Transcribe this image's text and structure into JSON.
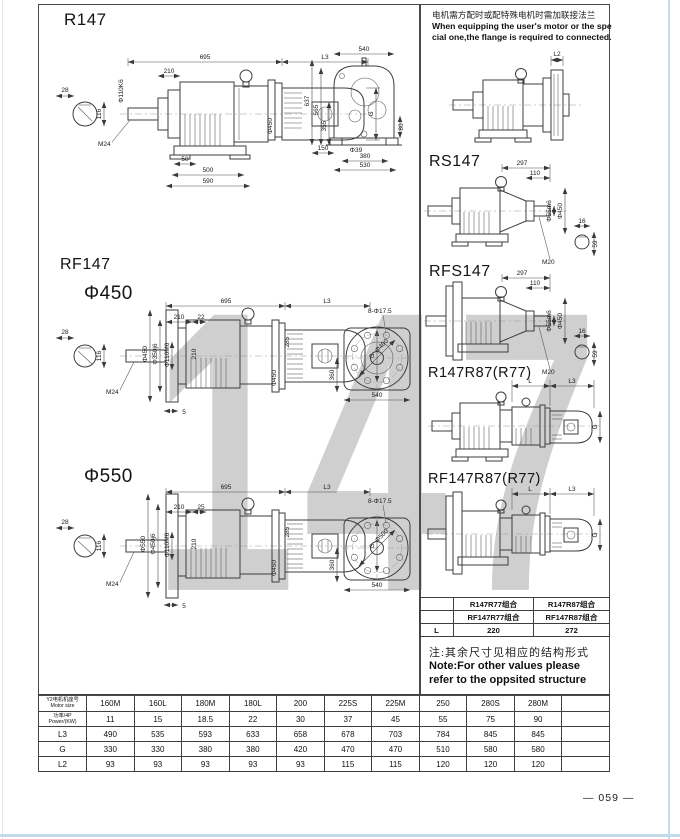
{
  "titles": {
    "r147": "R147",
    "rf147": "RF147",
    "phi450": "Φ450",
    "phi550": "Φ550",
    "rs147": "RS147",
    "rfs147": "RFS147",
    "r147r87": "R147R87(R77)",
    "rf147r87": "RF147R87(R77)"
  },
  "watermark": "147",
  "page_number": "— 059 —",
  "note_top": {
    "zh": "电机需方配时或配特殊电机时需加联接法兰",
    "en1": "When equipping the user's motor or the spe",
    "en2": "cial one,the flange is required to connected."
  },
  "note_bottom": {
    "zh": "注:其余尺寸见相应的结构形式",
    "en1": "Note:For other values please",
    "en2": "refer to the oppsited structure"
  },
  "combo": {
    "r1": [
      "",
      "R147R77组合",
      "R147R87组合"
    ],
    "r2": [
      "",
      "RF147R77组合",
      "RF147R87组合"
    ],
    "r3": [
      "L",
      "220",
      "272"
    ]
  },
  "size_table": {
    "header": {
      "line1": "Y2电机机座号",
      "line2": "Motor size"
    },
    "power": {
      "line1": "功率/4P",
      "line2": "Power/(KW)"
    },
    "labels": {
      "L3": "L3",
      "G": "G",
      "L2": "L2"
    },
    "columns": [
      "160M",
      "160L",
      "180M",
      "180L",
      "200",
      "225S",
      "225M",
      "250",
      "280S",
      "280M",
      ""
    ],
    "power_values": [
      "11",
      "15",
      "18.5",
      "22",
      "30",
      "37",
      "45",
      "55",
      "75",
      "90",
      ""
    ],
    "L3": [
      "490",
      "535",
      "593",
      "633",
      "658",
      "678",
      "703",
      "784",
      "845",
      "845",
      ""
    ],
    "G": [
      "330",
      "330",
      "380",
      "380",
      "420",
      "470",
      "470",
      "510",
      "580",
      "580",
      ""
    ],
    "L2": [
      "93",
      "93",
      "93",
      "93",
      "93",
      "115",
      "115",
      "120",
      "120",
      "120",
      ""
    ]
  },
  "dims": {
    "r147_side": {
      "w28": "28",
      "h116": "116",
      "shaft_dia": "Φ110K6",
      "m24": "M24",
      "w210": "210",
      "w695": "695",
      "L3": "L3",
      "coupling_dia": "Φ450",
      "G": "G",
      "w50": "50",
      "w500": "500",
      "w590": "590"
    },
    "r147_rear": {
      "w540": "540",
      "h637": "637",
      "h565": "565",
      "h355": "355",
      "h80": "80",
      "w150": "150",
      "hole": "Φ39",
      "w380": "380",
      "w530": "530"
    },
    "rf450": {
      "w28": "28",
      "h116": "116",
      "flange_dia": "Φ450",
      "spigot_dia": "Φ350j6",
      "bore_dia": "Φ110M6",
      "m24": "M24",
      "w210": "210",
      "w22": "22",
      "w695": "695",
      "L3": "L3",
      "h210": "210",
      "coupling_dia": "Φ450",
      "h285": "285",
      "G": "G",
      "w5": "5",
      "holes": "8-Φ17.5",
      "bolt_circle": "Φ400",
      "h360": "360",
      "w540": "540"
    },
    "rf550": {
      "w28": "28",
      "h116": "116",
      "flange_dia": "Φ550",
      "spigot_dia": "Φ450j6",
      "bore_dia": "Φ110M6",
      "m24": "M24",
      "w210": "210",
      "w25": "25",
      "w695": "695",
      "L3": "L3",
      "h210": "210",
      "coupling_dia": "Φ450",
      "h285": "285",
      "G": "G",
      "w5": "5",
      "holes": "8-Φ17.5",
      "bolt_circle": "Φ500",
      "h360": "360",
      "w540": "540"
    },
    "flange_note": {
      "L2": "L2"
    },
    "rs147": {
      "w297": "297",
      "w110": "110",
      "shaft_dia": "Φ55m6",
      "flange_dia": "Φ450",
      "m20": "M20",
      "w16": "16",
      "h59": "59"
    },
    "rfs147": {
      "w297": "297",
      "w110": "110",
      "shaft_dia": "Φ55m6",
      "flange_dia": "Φ450",
      "m20": "M20",
      "w16": "16",
      "h59": "59"
    },
    "r147r87": {
      "L": "L",
      "L3": "L3",
      "G": "G"
    },
    "rf147r87": {
      "L": "L",
      "L3": "L3",
      "G": "G"
    }
  },
  "colors": {
    "line": "#3d3d3d",
    "scan_edge": "#c2dcea",
    "watermark": "#a0a0a0"
  }
}
